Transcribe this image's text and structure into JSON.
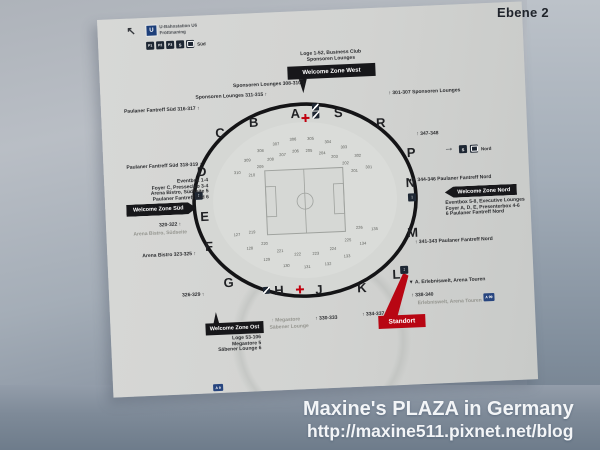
{
  "scene": {
    "level_title": "Ebene 2",
    "watermark1": "Maxine's PLAZA in Germany",
    "watermark2": "http://maxine511.pixnet.net/blog"
  },
  "colors": {
    "accent_red": "#b80613",
    "box_black": "#17171a",
    "sign_grey": "#d2d3d1",
    "wall_blue": "#7b8795"
  },
  "icons": {
    "arrow_upleft": "↖",
    "arrow_right": "→",
    "elevator": "↕",
    "sbahn": "S"
  },
  "transport_left": {
    "u": "U",
    "u_line1": "U-Bahnstation U6",
    "u_line2": "Fröttmaning",
    "p1": "P1",
    "p2": "P2",
    "p3": "P3",
    "region": "Süd"
  },
  "transport_right": {
    "region": "Nord"
  },
  "zone_west": {
    "label": "Welcome Zone West",
    "line1": "Loge 1-52, Business Club",
    "line2": "Sponsoren Lounges"
  },
  "zone_sued": {
    "label": "Welcome Zone Süd",
    "lines": [
      "Eventbox 1-4",
      "Foyer C, Presseclub 3-4",
      "Arena Bistro, Südseite 5",
      "Paulaner Fantreff Süd 6"
    ]
  },
  "zone_nord": {
    "label": "Welcome Zone Nord",
    "lines": [
      "Eventbox 5-8, Executive Lounges",
      "Foyer A, D, E, Presenterbox 4-6",
      "6 Paulaner Fantreff Nord"
    ]
  },
  "zone_ost": {
    "label": "Welcome Zone Ost",
    "lines": [
      "Loge 53-106",
      "Megastore 5",
      "Säbener Lounge 6"
    ]
  },
  "standort": {
    "label": "Standort"
  },
  "labels": {
    "a_sp1": "Sponsoren Lounges 308-310 ↑",
    "a_sp2": "Sponsoren Lounges 311-315 ↑",
    "a_pf1": "Paulaner Fantreff Süd 316-317 ↑",
    "a_pf2": "Paulaner Fantreff Süd 318-319 ↑",
    "a_320": "320-322 ↑",
    "a_bistro_s": "Arena Bistro, Südseite",
    "a_323": "Arena Bistro 323-325 ↑",
    "a_326": "326-329 ↑",
    "a_megastore": "↑ Megastore",
    "a_saebener": "Säbener Lounge",
    "a_330": "↑ 330-333",
    "a_334": "↑ 334-337",
    "a_301": "↑ 301-307 Sponsoren Lounges",
    "a_347": "↑ 347-348",
    "a_344": "◄ ↑ 344-346 Paulaner Fantreff Nord",
    "a_341": "↑ 341-343 Paulaner Fantreff Nord",
    "a_erlebnis1": "▼ A. Erlebniswelt, Arena Touren",
    "a_338": "↑ 338-340",
    "a_erlebnis2": "Erlebniswelt, Arena Touren",
    "a_a9": "A 9",
    "a_a99": "A 99"
  },
  "map": {
    "sections": [
      "B",
      "A",
      "S",
      "R",
      "C",
      "D",
      "E",
      "F",
      "G",
      "H",
      "J",
      "K",
      "L",
      "M",
      "N",
      "P"
    ],
    "rings": {
      "top_outer": [
        "310",
        "309",
        "308",
        "307",
        "306",
        "305",
        "304",
        "303",
        "302",
        "301"
      ],
      "top_inner": [
        "210",
        "209",
        "208",
        "207",
        "206",
        "205",
        "204",
        "203",
        "202",
        "201"
      ],
      "bottom_outer": [
        "127",
        "128",
        "129",
        "130",
        "131",
        "132",
        "133",
        "134",
        "135"
      ],
      "bottom_inner": [
        "219",
        "220",
        "221",
        "222",
        "223",
        "224",
        "225",
        "226"
      ]
    }
  }
}
